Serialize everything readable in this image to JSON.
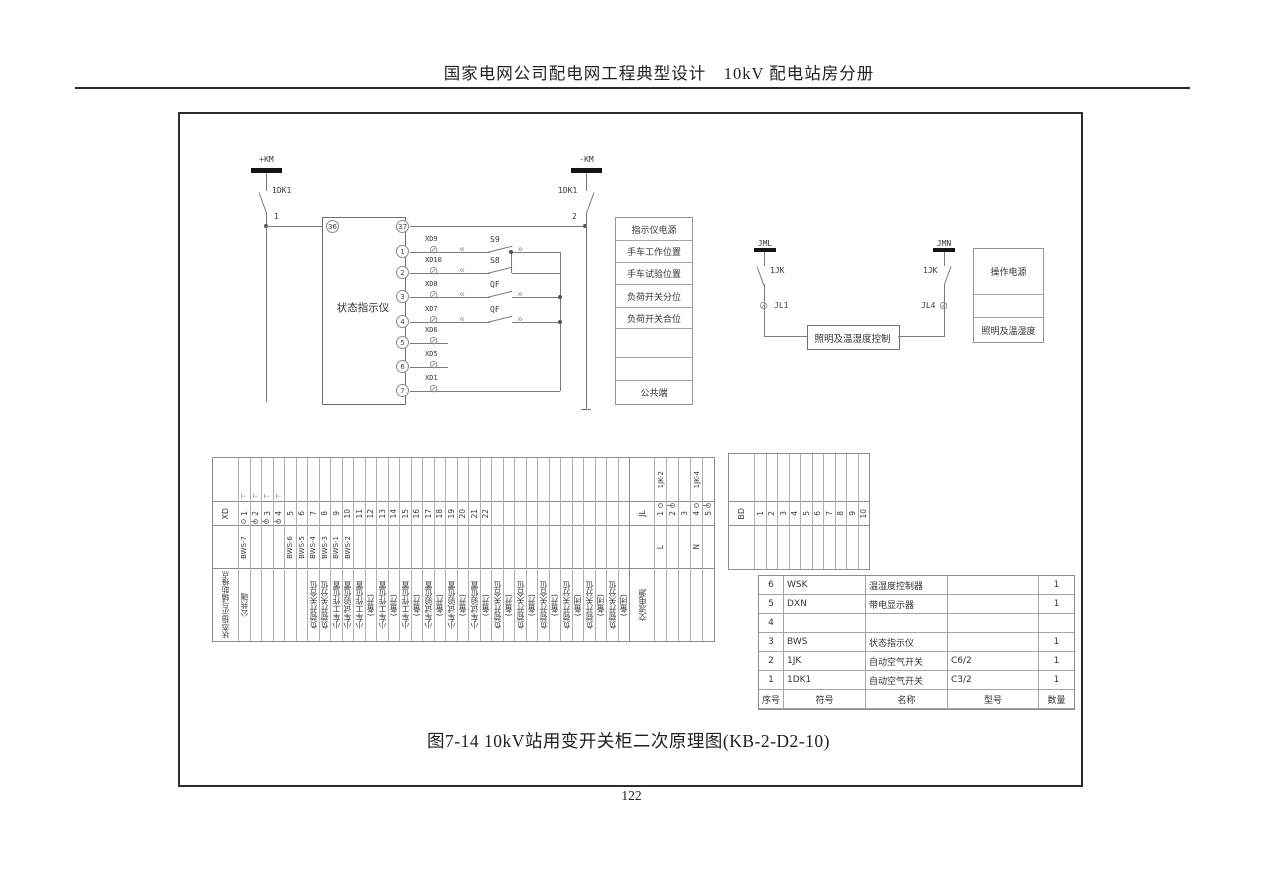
{
  "page": {
    "header_title": "国家电网公司配电网工程典型设计　10kV 配电站房分册",
    "caption": "图7-14 10kV站用变开关柜二次原理图(KB-2-D2-10)",
    "page_number": "122"
  },
  "circuit_left": {
    "bus_pos": "+KM",
    "bus_neg": "-KM",
    "breaker_left": "1DK1",
    "breaker_right": "1DK1",
    "wire_1": "1",
    "wire_2": "2",
    "device_box": "状态指示仪",
    "terminal_36": "36",
    "terminal_37": "37",
    "rows": [
      {
        "num": "1",
        "xd": "XD9",
        "sw": "S9"
      },
      {
        "num": "2",
        "xd": "XD10",
        "sw": "S8"
      },
      {
        "num": "3",
        "xd": "XD8",
        "sw": "QF"
      },
      {
        "num": "4",
        "xd": "XD7",
        "sw": "QF"
      },
      {
        "num": "5",
        "xd": "XD6",
        "sw": ""
      },
      {
        "num": "6",
        "xd": "XD5",
        "sw": ""
      },
      {
        "num": "7",
        "xd": "XD1",
        "sw": ""
      }
    ]
  },
  "signal_table": {
    "rows": [
      "指示仪电源",
      "手车工作位置",
      "手车试验位置",
      "负荷开关分位",
      "负荷开关合位",
      "",
      "",
      "公共端"
    ]
  },
  "circuit_right": {
    "bus_left": "JML",
    "bus_right": "JMN",
    "breaker_left": "1JK",
    "breaker_right": "1JK",
    "terminal_left": "JL1",
    "terminal_right": "JL4",
    "control_box": "照明及温湿度控制",
    "legend": [
      "操作电源",
      "",
      "照明及温湿度"
    ]
  },
  "xd_strip": {
    "row_label": "XD",
    "group_label": "状态指示与辅助接点",
    "columns": [
      {
        "n": "1",
        "w": "BWS-7",
        "f": "公共端",
        "j": "start",
        "m": true
      },
      {
        "n": "2",
        "w": "",
        "f": "",
        "j": "link",
        "m": true
      },
      {
        "n": "3",
        "w": "",
        "f": "",
        "j": "link",
        "m": true
      },
      {
        "n": "4",
        "w": "",
        "f": "",
        "j": "link",
        "m": true
      },
      {
        "n": "5",
        "w": "BWS-6",
        "f": "",
        "j": "",
        "m": false
      },
      {
        "n": "6",
        "w": "BWS-5",
        "f": "",
        "j": "",
        "m": false
      },
      {
        "n": "7",
        "w": "BWS-4",
        "f": "负荷开关合位",
        "j": "",
        "m": false
      },
      {
        "n": "8",
        "w": "BWS-3",
        "f": "负荷开关分位",
        "j": "",
        "m": false
      },
      {
        "n": "9",
        "w": "BWS-1",
        "f": "小车工作位置",
        "j": "",
        "m": false
      },
      {
        "n": "10",
        "w": "BWS-2",
        "f": "小车试验位置",
        "j": "",
        "m": false
      },
      {
        "n": "11",
        "w": "",
        "f": "小车工作位置",
        "j": "",
        "m": false
      },
      {
        "n": "12",
        "w": "",
        "f": "(备开)",
        "j": "",
        "m": false
      },
      {
        "n": "13",
        "w": "",
        "f": "小车工作位置",
        "j": "",
        "m": false
      },
      {
        "n": "14",
        "w": "",
        "f": "(备开)",
        "j": "",
        "m": false
      },
      {
        "n": "15",
        "w": "",
        "f": "小车工作位置",
        "j": "",
        "m": false
      },
      {
        "n": "16",
        "w": "",
        "f": "(备开)",
        "j": "",
        "m": false
      },
      {
        "n": "17",
        "w": "",
        "f": "小车试验位置",
        "j": "",
        "m": false
      },
      {
        "n": "18",
        "w": "",
        "f": "(备开)",
        "j": "",
        "m": false
      },
      {
        "n": "19",
        "w": "",
        "f": "小车试验位置",
        "j": "",
        "m": false
      },
      {
        "n": "20",
        "w": "",
        "f": "(备开)",
        "j": "",
        "m": false
      },
      {
        "n": "21",
        "w": "",
        "f": "小车试验位置",
        "j": "",
        "m": false
      },
      {
        "n": "22",
        "w": "",
        "f": "(备开)",
        "j": "",
        "m": false
      },
      {
        "n": "",
        "w": "",
        "f": "负荷开关合位",
        "j": "",
        "m": false
      },
      {
        "n": "",
        "w": "",
        "f": "(备开)",
        "j": "",
        "m": false
      },
      {
        "n": "",
        "w": "",
        "f": "负荷开关合位",
        "j": "",
        "m": false
      },
      {
        "n": "",
        "w": "",
        "f": "(备开)",
        "j": "",
        "m": false
      },
      {
        "n": "",
        "w": "",
        "f": "负荷开关合位",
        "j": "",
        "m": false
      },
      {
        "n": "",
        "w": "",
        "f": "(备开)",
        "j": "",
        "m": false
      },
      {
        "n": "",
        "w": "",
        "f": "负荷开关分位",
        "j": "",
        "m": false
      },
      {
        "n": "",
        "w": "",
        "f": "(备闭)",
        "j": "",
        "m": false
      },
      {
        "n": "",
        "w": "",
        "f": "负荷开关分位",
        "j": "",
        "m": false
      },
      {
        "n": "",
        "w": "",
        "f": "(备闭)",
        "j": "",
        "m": false
      },
      {
        "n": "",
        "w": "",
        "f": "负荷开关分位",
        "j": "",
        "m": false
      },
      {
        "n": "",
        "w": "",
        "f": "(备闭)",
        "j": "",
        "m": false
      }
    ]
  },
  "jl_strip": {
    "row_label": "JL",
    "group_label": "交流电源",
    "columns": [
      {
        "n": "1",
        "t": "1JK-2",
        "w": "L",
        "j": "start"
      },
      {
        "n": "2",
        "t": "",
        "w": "",
        "j": "link"
      },
      {
        "n": "3",
        "t": "",
        "w": "",
        "j": ""
      },
      {
        "n": "4",
        "t": "1JK-4",
        "w": "N",
        "j": "start"
      },
      {
        "n": "5",
        "t": "",
        "w": "",
        "j": "link"
      }
    ]
  },
  "bd_strip": {
    "row_label": "BD",
    "columns": [
      "1",
      "2",
      "3",
      "4",
      "5",
      "6",
      "7",
      "8",
      "9",
      "10"
    ]
  },
  "equipment_table": {
    "headers": [
      "序号",
      "符号",
      "名称",
      "型号",
      "数量"
    ],
    "rows": [
      [
        "6",
        "WSK",
        "温湿度控制器",
        "",
        "1"
      ],
      [
        "5",
        "DXN",
        "带电显示器",
        "",
        "1"
      ],
      [
        "4",
        "",
        "",
        "",
        ""
      ],
      [
        "3",
        "BWS",
        "状态指示仪",
        "",
        "1"
      ],
      [
        "2",
        "1JK",
        "自动空气开关",
        "C6/2",
        "1"
      ],
      [
        "1",
        "1DK1",
        "自动空气开关",
        "C3/2",
        "1"
      ]
    ]
  }
}
